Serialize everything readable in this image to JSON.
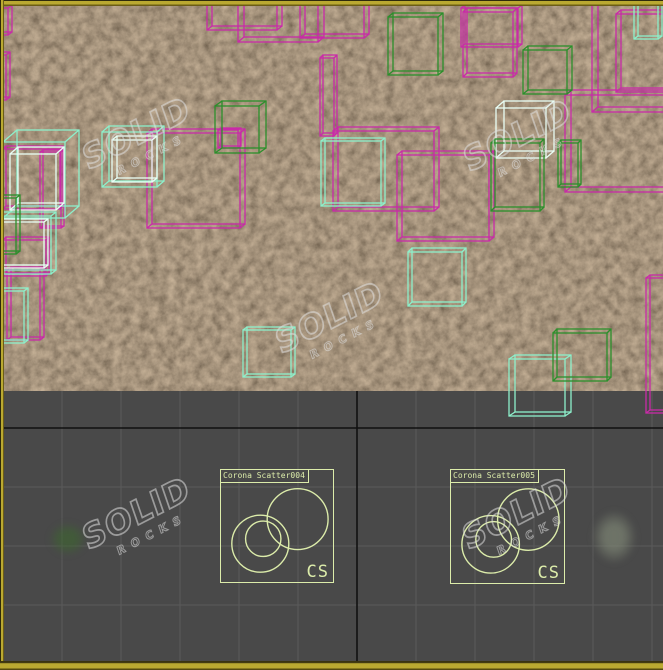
{
  "viewport": {
    "type_label": "top-orthographic-viewport",
    "background": "#494949",
    "active_border_color": "#baa931",
    "texture_base_color": "#5d4a33",
    "grid": {
      "minor_color": "#5a5a5a",
      "axis_color": "#111111",
      "spacing": 59,
      "origin": [
        357,
        428
      ],
      "top": 391,
      "bottom": 661,
      "left": 4,
      "right": 663
    }
  },
  "palette": {
    "magenta": "#c92ba8",
    "mint": "#8df0cb",
    "white": "#e9fff6",
    "green": "#2b8f2b",
    "icon": "#dcecaa"
  },
  "scatter_icons": [
    {
      "label": "Corona Scatter004",
      "monogram": "CS",
      "x": 220,
      "y": 469,
      "size": 114
    },
    {
      "label": "Corona Scatter005",
      "monogram": "CS",
      "x": 450,
      "y": 469,
      "size": 115
    }
  ],
  "watermark": {
    "line1": "SOLID",
    "line2": "ROCKS",
    "color": "rgba(222,222,222,0.55)",
    "positions": [
      [
        140,
        148
      ],
      [
        521,
        150
      ],
      [
        333,
        332
      ],
      [
        140,
        528
      ],
      [
        520,
        528
      ]
    ]
  },
  "cubes": [
    {
      "color": "magenta",
      "box": [
        -22,
        8,
        30,
        27,
        4,
        -3
      ]
    },
    {
      "color": "magenta",
      "box": [
        -16,
        55,
        22,
        45,
        4,
        -3
      ]
    },
    {
      "color": "magenta",
      "box": [
        207,
        -20,
        70,
        50,
        5,
        -4
      ]
    },
    {
      "color": "magenta",
      "box": [
        238,
        -30,
        80,
        72,
        6,
        -5
      ]
    },
    {
      "color": "magenta",
      "box": [
        300,
        -14,
        64,
        52,
        5,
        -4
      ]
    },
    {
      "color": "magenta",
      "box": [
        320,
        58,
        14,
        78,
        3,
        -3
      ]
    },
    {
      "color": "magenta",
      "box": [
        461,
        8,
        57,
        39,
        4,
        -3
      ]
    },
    {
      "color": "magenta",
      "box": [
        463,
        12,
        50,
        65,
        4,
        -4
      ]
    },
    {
      "color": "magenta",
      "box": [
        592,
        -18,
        128,
        130,
        6,
        -5
      ]
    },
    {
      "color": "magenta",
      "box": [
        616,
        14,
        110,
        78,
        5,
        -4
      ]
    },
    {
      "color": "magenta",
      "box": [
        565,
        95,
        135,
        97,
        6,
        -5
      ]
    },
    {
      "color": "magenta",
      "box": [
        333,
        131,
        101,
        80,
        5,
        -4
      ]
    },
    {
      "color": "magenta",
      "box": [
        397,
        155,
        92,
        86,
        5,
        -4
      ]
    },
    {
      "color": "magenta",
      "box": [
        147,
        133,
        93,
        95,
        5,
        -4
      ]
    },
    {
      "color": "magenta",
      "box": [
        3,
        149,
        57,
        60,
        3,
        -3
      ]
    },
    {
      "color": "magenta",
      "box": [
        40,
        152,
        21,
        76,
        3,
        -2
      ]
    },
    {
      "color": "magenta",
      "box": [
        3,
        240,
        43,
        36,
        3,
        -3
      ]
    },
    {
      "color": "magenta",
      "box": [
        7,
        270,
        33,
        70,
        4,
        -3
      ]
    },
    {
      "color": "magenta",
      "box": [
        218,
        130,
        20,
        18,
        3,
        -2
      ]
    },
    {
      "color": "magenta",
      "box": [
        646,
        278,
        40,
        135,
        4,
        -3
      ]
    },
    {
      "color": "mint",
      "box": [
        3,
        142,
        62,
        76,
        14,
        -12
      ]
    },
    {
      "color": "white",
      "box": [
        10,
        154,
        46,
        56,
        8,
        -7
      ]
    },
    {
      "color": "mint",
      "box": [
        102,
        132,
        55,
        55,
        7,
        -6
      ]
    },
    {
      "color": "white",
      "box": [
        112,
        140,
        40,
        42,
        5,
        -4
      ]
    },
    {
      "color": "mint",
      "box": [
        -15,
        216,
        66,
        58,
        5,
        -4
      ]
    },
    {
      "color": "white",
      "box": [
        -8,
        222,
        52,
        46,
        4,
        -3
      ]
    },
    {
      "color": "mint",
      "box": [
        -20,
        291,
        44,
        52,
        4,
        -3
      ]
    },
    {
      "color": "mint",
      "box": [
        243,
        330,
        48,
        47,
        4,
        -3
      ]
    },
    {
      "color": "mint",
      "box": [
        408,
        252,
        54,
        54,
        4,
        -4
      ]
    },
    {
      "color": "mint",
      "box": [
        509,
        359,
        56,
        57,
        6,
        -4
      ]
    },
    {
      "color": "mint",
      "box": [
        321,
        141,
        60,
        65,
        4,
        -3
      ]
    },
    {
      "color": "mint",
      "box": [
        634,
        5,
        24,
        34,
        4,
        -3
      ]
    },
    {
      "color": "white",
      "box": [
        496,
        108,
        50,
        50,
        8,
        -7
      ]
    },
    {
      "color": "green",
      "box": [
        215,
        106,
        44,
        47,
        7,
        -5
      ]
    },
    {
      "color": "green",
      "box": [
        388,
        17,
        50,
        58,
        5,
        -4
      ]
    },
    {
      "color": "green",
      "box": [
        523,
        50,
        44,
        44,
        5,
        -4
      ]
    },
    {
      "color": "green",
      "box": [
        491,
        143,
        49,
        68,
        4,
        -4
      ]
    },
    {
      "color": "green",
      "box": [
        558,
        143,
        20,
        44,
        3,
        -3
      ]
    },
    {
      "color": "green",
      "box": [
        553,
        333,
        54,
        48,
        4,
        -4
      ]
    },
    {
      "color": "green",
      "box": [
        -8,
        198,
        24,
        56,
        4,
        -3
      ]
    }
  ],
  "plants": [
    {
      "x": 68,
      "y": 539,
      "w": 46,
      "h": 40,
      "inner": "rgba(60,105,45,0.55)",
      "outer": "rgba(40,70,35,0.0)"
    },
    {
      "x": 614,
      "y": 537,
      "w": 54,
      "h": 64,
      "inner": "rgba(130,138,120,0.65)",
      "outer": "rgba(70,110,55,0.0)"
    }
  ]
}
